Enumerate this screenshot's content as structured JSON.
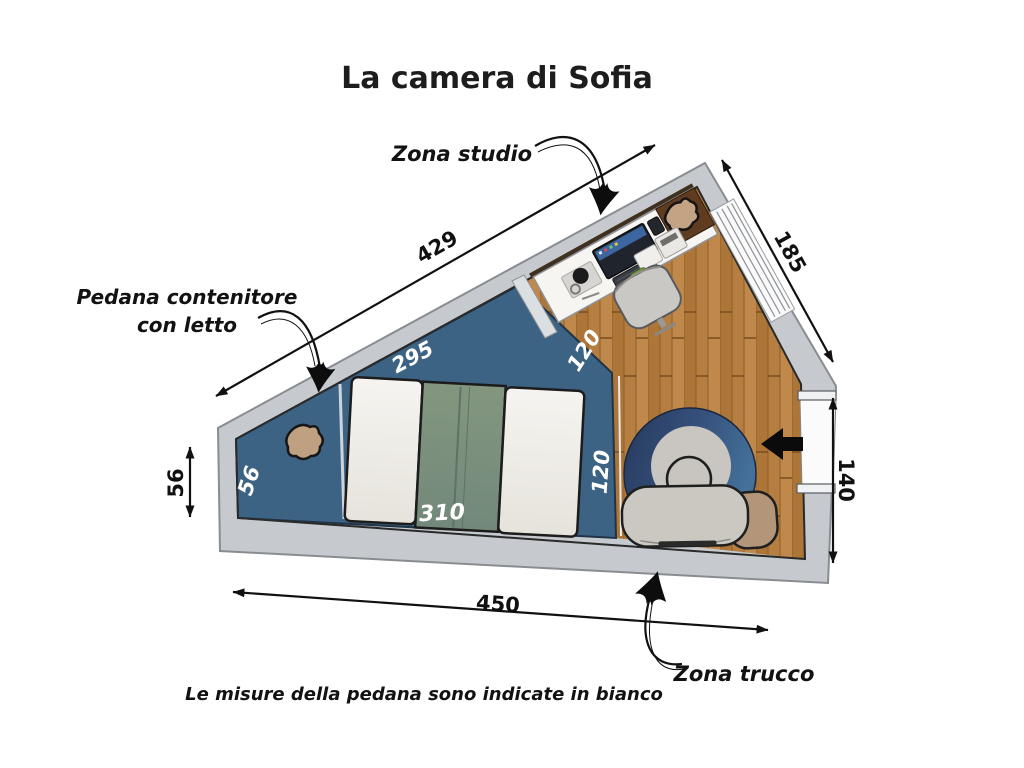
{
  "title": "La camera di Sofia",
  "footnote": "Le misure della pedana sono indicate in bianco",
  "zones": {
    "studio": {
      "label": "Zona studio"
    },
    "pedana": {
      "label_line1": "Pedana contenitore",
      "label_line2": "con letto"
    },
    "trucco": {
      "label": "Zona trucco"
    }
  },
  "dimensions_cm": {
    "top_wall": "429",
    "upper_right_wall": "185",
    "right_wall": "140",
    "left_wall": "56",
    "bottom_wall": "450"
  },
  "platform_measures_cm": {
    "top_edge": "295",
    "desk_edge": "120",
    "left_edge": "56",
    "right_edge": "120",
    "bed_side": "310"
  },
  "colors": {
    "wall_gray": "#c6cace",
    "platform_blue": "#3d6384",
    "wood_floor": "#b67f41",
    "bed_green": "#7b907d",
    "bed_white": "#f2f0ea",
    "rug_navy": "#2a3d61",
    "rug_blue": "#41678f",
    "rug_center": "#c9c6c1",
    "tan_accent": "#bfa080",
    "text_black": "#141414",
    "text_white": "#ffffff"
  }
}
